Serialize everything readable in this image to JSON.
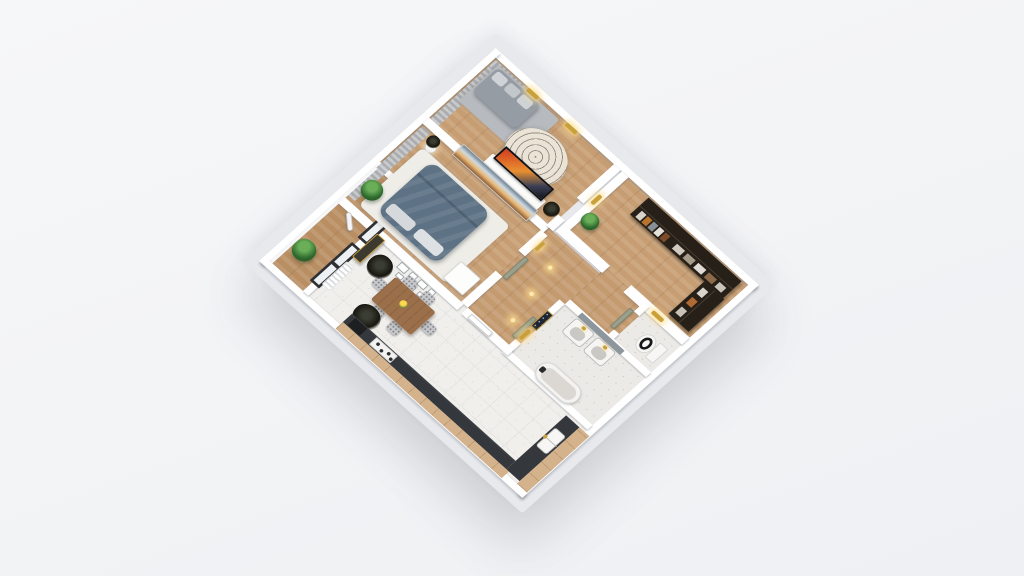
{
  "meta": {
    "description": "3D dollhouse-style isometric rendering of a one-bedroom apartment floor plan, viewed from above, rotated 45 degrees on a light grey background",
    "view": "isometric top-down",
    "rotation_deg": 45
  },
  "colors": {
    "background": "#f3f4f6",
    "slab": "#e7e9ed",
    "wall": "#ffffff",
    "wood_floor": "#c79e73",
    "wood_hall": "#c49a6f",
    "wood_balcony": "#b98e62",
    "cabinet_wood": "#d3b28c",
    "living_tile": "#f0efec",
    "bath_floor": "#eceae7",
    "curtain": "#b9bdc1",
    "sofa": "#969ca3",
    "sofa_rug": "#b7bbc0",
    "round_rug": "#eae3d6",
    "white_rug": "#efede7",
    "bed_duvet": "#5d7284",
    "pillow": "#d5d9dc",
    "closet_dark": "#262019",
    "kitchen_counter": "#34373b",
    "dining_table": "#9a6f4a",
    "chair": "#c6c8cb",
    "door_sage": "#99a08b",
    "gold_fixture": "#c9a13b",
    "plant_green": "#2f6b2e",
    "dried_plant": "#17150f",
    "window_frame": "#2e3033",
    "vanity_tile": "#8d969d",
    "tv_stand": "#fbfbfa",
    "mirror_leaning": "#3c3931"
  },
  "rooms": [
    {
      "id": "bedroom-2",
      "name": "Second bedroom / TV room",
      "floor": "wood",
      "items": [
        "grey corner sofa with cushions",
        "grey area rug",
        "TV with sunset picture on white media stand",
        "round patterned boho rug",
        "grey curtains on two walls",
        "gold wall sconces",
        "dark potted plant"
      ]
    },
    {
      "id": "wardrobe",
      "name": "Walk-in wardrobe",
      "floor": "wood",
      "items": [
        "dark L-shaped closet with hanging clothes and folded stacks",
        "potted plant",
        "gold wall sconce"
      ]
    },
    {
      "id": "bedroom-1",
      "name": "Master bedroom",
      "floor": "wood",
      "items": [
        "double bed with teal-grey duvet and light pillows",
        "white area rug",
        "wide sunset landscape artwork on wall",
        "white floor lamp",
        "white dresser",
        "grey curtains",
        "dark plant"
      ]
    },
    {
      "id": "hallway",
      "name": "Hallway",
      "floor": "wood",
      "items": [
        "sage interior doors",
        "navy framed picture with gold trim",
        "gold ceiling lights",
        "white entry door"
      ]
    },
    {
      "id": "wc",
      "name": "WC",
      "floor": "speckled tile",
      "items": [
        "toilet with black seat",
        "gold wall sconce"
      ]
    },
    {
      "id": "bathroom",
      "name": "Bathroom",
      "floor": "speckled terrazzo",
      "items": [
        "double vanity with gold faucets",
        "grey tiled backsplash wall",
        "white bathtub with dark faucet",
        "gold sconce on outer wall"
      ]
    },
    {
      "id": "living-kitchen",
      "name": "Living / dining / kitchen",
      "floor": "white tile",
      "items": [
        "wooden dining table with flowers",
        "six patterned grey chairs",
        "gallery wall of small white frames",
        "white radiator under window",
        "leaning dark mirror",
        "two dried dark plants",
        "L-shaped kitchen with dark countertop",
        "double sink",
        "cooktop with four burners",
        "dark appliance",
        "wooden cabinet fronts"
      ]
    },
    {
      "id": "balcony",
      "name": "Balcony",
      "floor": "wood",
      "items": [
        "two green potted plants",
        "white telescope",
        "black framed glass doors to living room",
        "white parapet"
      ]
    }
  ]
}
